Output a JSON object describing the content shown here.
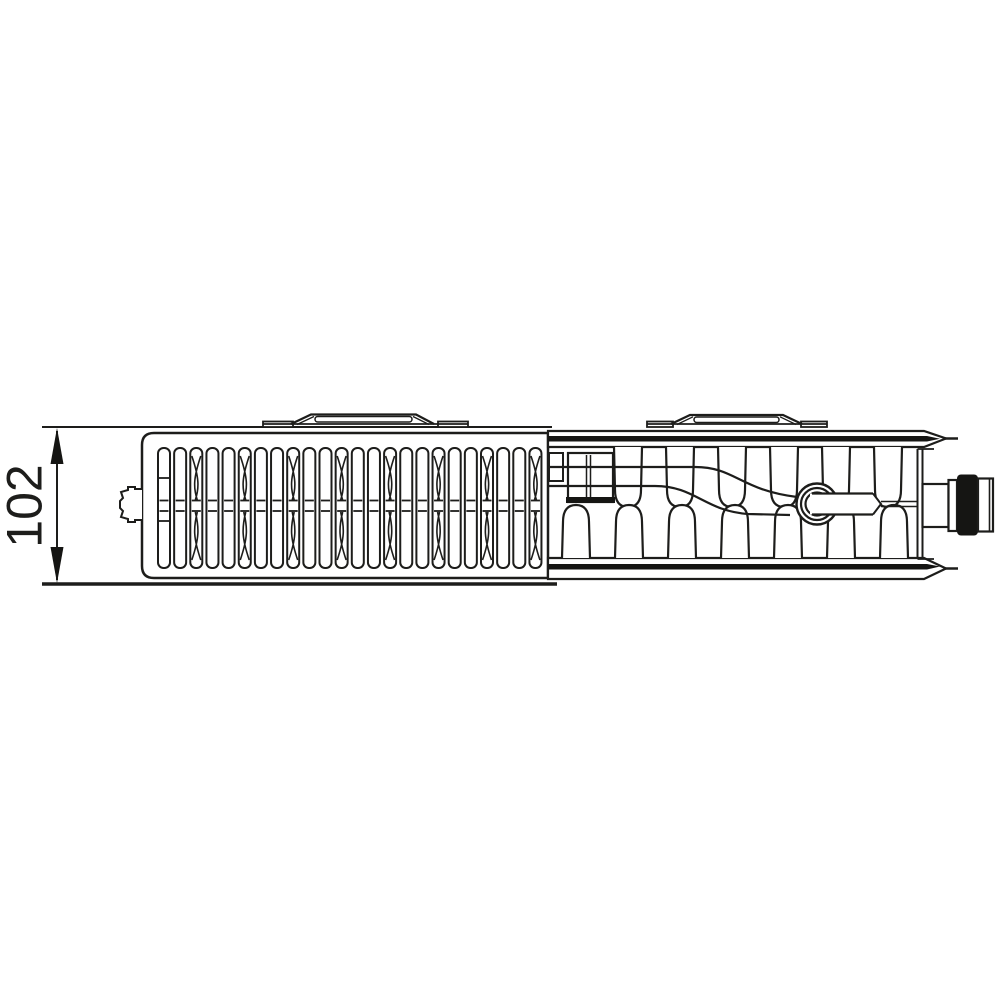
{
  "diagram": {
    "type": "technical-drawing",
    "subject": "radiator-plan-view-with-cross-section",
    "dimension": {
      "label": "102"
    },
    "colors": {
      "line": "#1d1d1b",
      "cut": "#151513",
      "fill": "#ffffff",
      "background": "#ffffff"
    },
    "geometry": {
      "grille": {
        "start_x": 158,
        "top_y": 448,
        "height": 120,
        "slat_count": 24,
        "pitch": 16.15,
        "slat_width": 12,
        "mid_lines_y": [
          500.5,
          511
        ],
        "hourglass_every": 3
      },
      "fins_top": {
        "centers": [
          628,
          680,
          732,
          784,
          836,
          888
        ],
        "base_y": 447,
        "tip_y": 507,
        "half_w": 14
      },
      "fins_bottom": {
        "centers": [
          576,
          629,
          682,
          735,
          788,
          841,
          894
        ],
        "base_y": 558,
        "tip_y": 505,
        "half_w": 14
      }
    }
  }
}
